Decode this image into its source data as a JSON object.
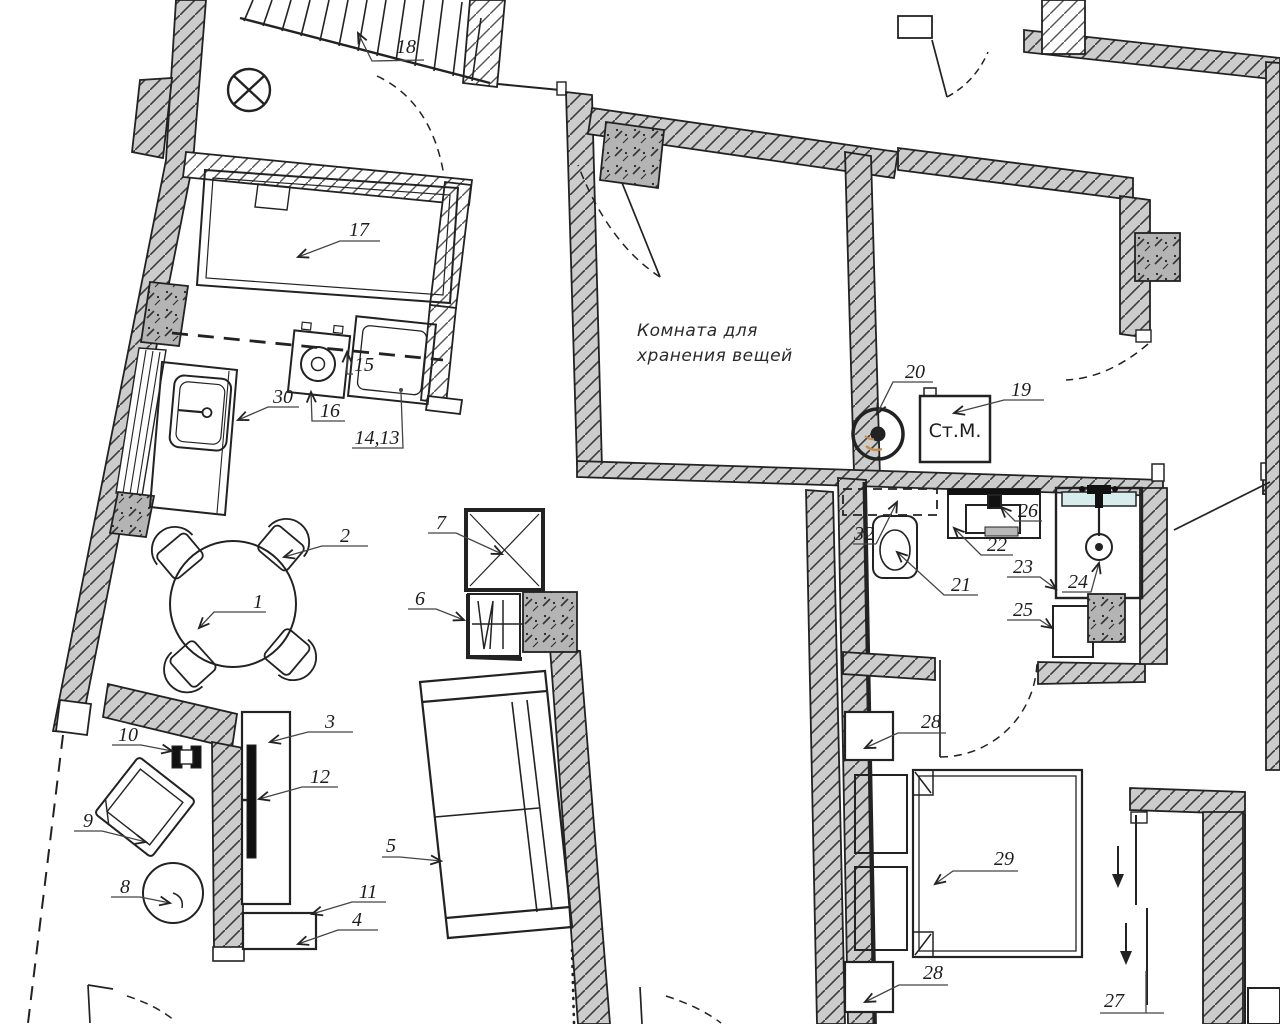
{
  "drawing": {
    "type": "apartment floor plan",
    "room_text": {
      "storage_line1": "Комната для",
      "storage_line2": "хранения вещей"
    },
    "appliances": {
      "washing_machine": "Ст.М."
    },
    "item_labels": {
      "n1": "1",
      "n2": "2",
      "n3": "3",
      "n4": "4",
      "n5": "5",
      "n6": "6",
      "n7": "7",
      "n8": "8",
      "n9": "9",
      "n10": "10",
      "n11": "11",
      "n12": "12",
      "n14_13": "14,13",
      "n15": "15",
      "n16": "16",
      "n17": "17",
      "n18": "18",
      "n19": "19",
      "n20": "20",
      "n21": "21",
      "n22": "22",
      "n23": "23",
      "n24": "24",
      "n25": "25",
      "n26": "26",
      "n27": "27",
      "n28": "28",
      "n29": "29",
      "n30": "30",
      "n32": "32"
    },
    "colors": {
      "line": "#222222",
      "wall_fill": "#cccccc",
      "column_fill": "#b4b4b4",
      "glass_shelf": "#d8ecee",
      "heater_accent": "#c98a4a",
      "background": "#ffffff"
    }
  }
}
